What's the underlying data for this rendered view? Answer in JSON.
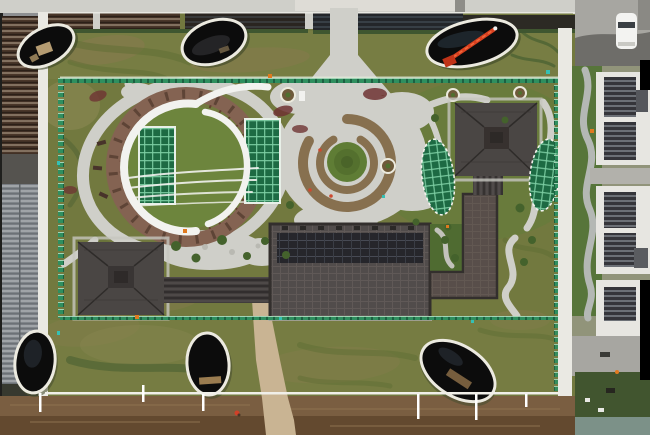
{
  "meta": {
    "title": "Aerial drone photo: rooftop garden of a Chinese-style building complex",
    "description": "Top-down aerial photograph of a landscaped green roof. A large circular brown walkway with white arc canopies sits left of a spiral planting bed on a concrete plaza. A dark tiled hall with a solar-panel band, two hip-roof pavilions and connecting corridors occupy the center. Six black oval skylights with white rims pierce the lawn; the top-right one contains a red crane arm. Green safety-mesh ovals, green guardrails, winding paths, a neighboring street with a white van and louvered-roof buildings frame the roof."
  },
  "palette": {
    "concrete": "#cfcfc9",
    "concrete_bright": "#dedcd6",
    "path_tan": "#c9b493",
    "lawn_base": "#72793f",
    "lawn_light": "#7c8148",
    "lawn_ne": "#5a8036",
    "lawn_inner": "#6c8a3d",
    "lawn_brown": "#8a7a50",
    "lawn_tan": "#98905e",
    "offsite_lawn": "#57753a",
    "offsite_lawn_dark": "#41552f",
    "hedge_green": "#3f5630",
    "bush_green": "#44622c",
    "flower_burgundy": "#6e3333",
    "soil": "#7a5e41",
    "soil_dark": "#63492f",
    "parapet_white": "#eae9e3",
    "canopy_white": "#f2f2ef",
    "skylight_black": "#0c0c0c",
    "skylight_rim": "#eceae0",
    "roof_main": "#514c4b",
    "roof_pavilion": "#4a4644",
    "roof_corridor": "#454140",
    "solar_panel": "#26262b",
    "road_gray": "#a7a6a1",
    "asphalt_dark": "#6e6d69",
    "car_white": "#f3f3f1",
    "offsite_roof_white": "#e7e6e1",
    "slat_dark": "#35353a",
    "canal_teal": "#7c9188",
    "marker_orange": "#e07a1f",
    "marker_cyan": "#35c0b4",
    "crane_red": "#d8401f",
    "planter_brown": "#6e5a3a",
    "rail_green": "#2f8f5f",
    "trellis_green": "#1d6a43",
    "trellis_line": "#7ecfa4",
    "ring_walk": "#846352",
    "ring_walk_dark": "#5e4436",
    "spiral_brown": "#87704f",
    "mow_dark": "#5d6d33",
    "swirl_deep": "#3f5a2e",
    "louver_brown": "#4a372a",
    "louver_gray": "#80858a"
  },
  "scene": {
    "features": [
      "rooftop-lawn",
      "oval-skylight x6",
      "red-crane-in-skylight",
      "circular-ring-walkway",
      "white-arc-canopies",
      "green-trellis-panels",
      "spiral-planting-bed",
      "central-green-mound",
      "main-hall-tiled-roof",
      "solar-panel-band",
      "ne-pavilion",
      "sw-pavilion",
      "connecting-corridors",
      "green-guardrail-perimeter",
      "mesh-covered-ovals x2",
      "concrete-plaza-paths",
      "tan-dirt-path",
      "street-with-white-van",
      "louvered-roof-buildings",
      "bare-soil-strip",
      "worker-figure",
      "orange-markers",
      "cyan-markers"
    ],
    "counts": {
      "oval_skylights": 6,
      "pavilions": 2,
      "trellis_ovals": 2,
      "vehicles": 1
    }
  }
}
